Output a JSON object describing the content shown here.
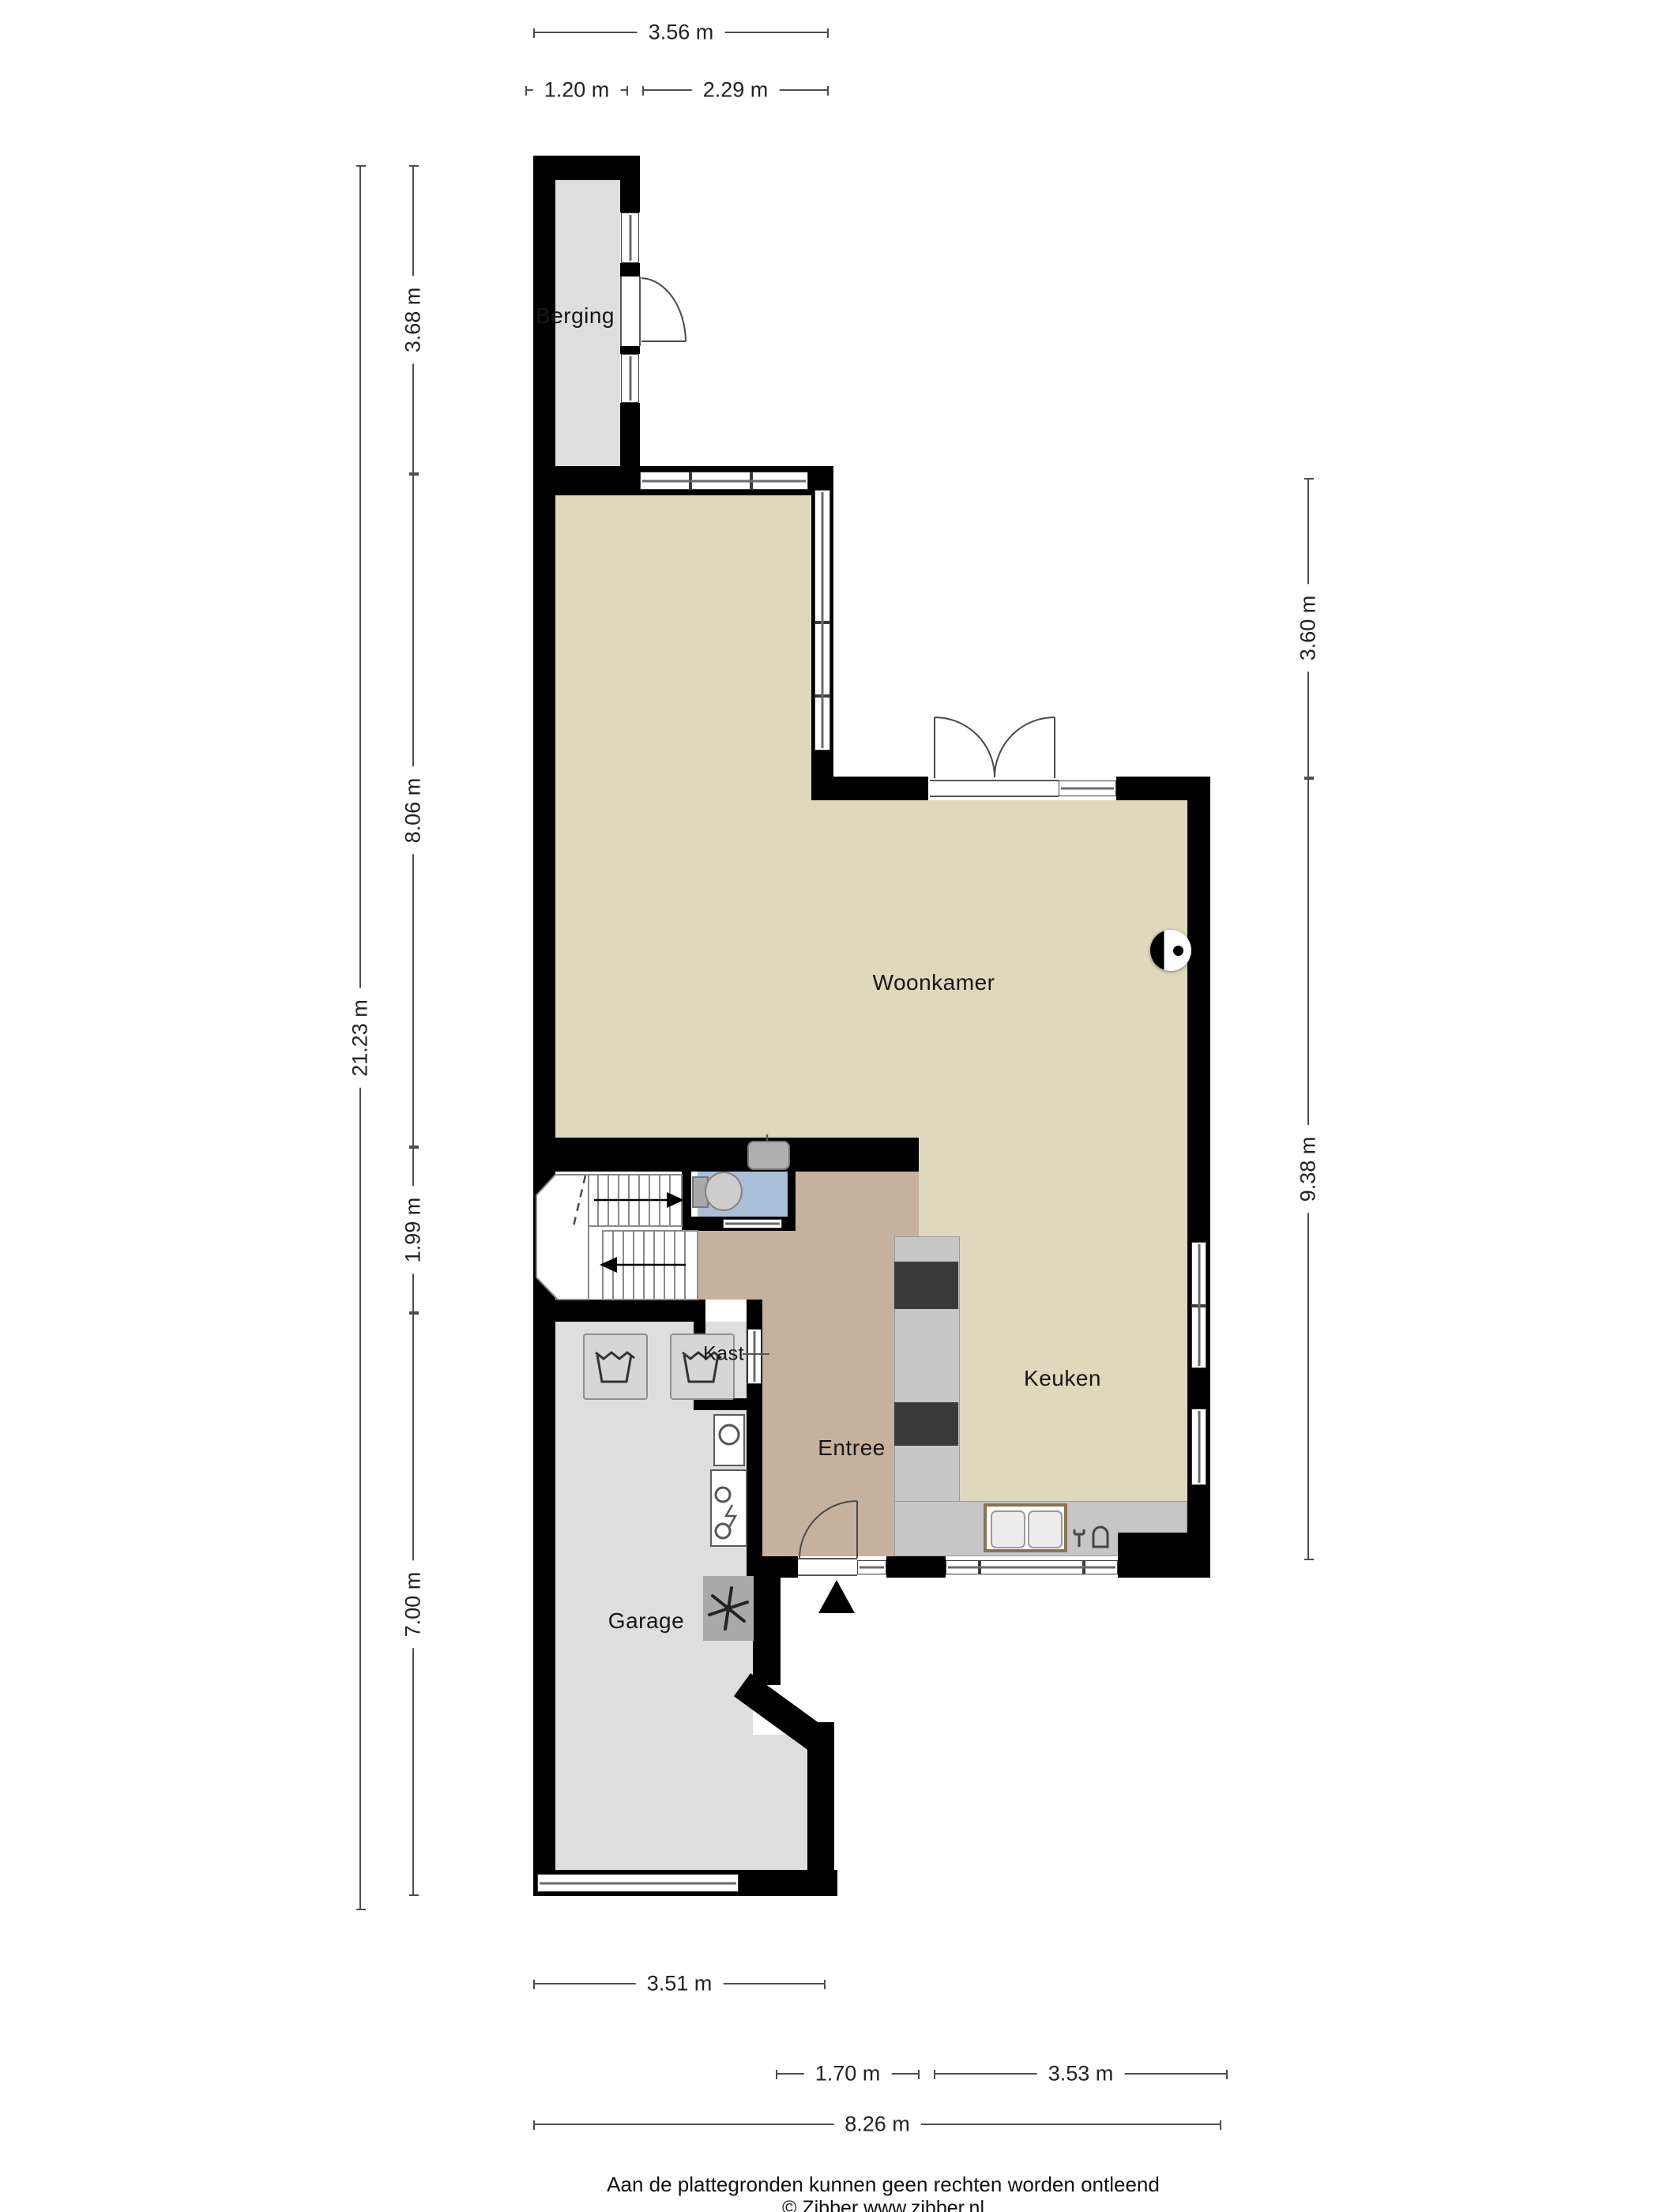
{
  "rooms": {
    "berging": "Berging",
    "woonkamer": "Woonkamer",
    "keuken": "Keuken",
    "entree": "Entree",
    "kast": "Kast",
    "garage": "Garage"
  },
  "dimensions": {
    "top_total": "3.56 m",
    "top_left": "1.20 m",
    "top_right": "2.29 m",
    "left_total": "21.23 m",
    "left_berging": "3.68 m",
    "left_woonkamer": "8.06 m",
    "left_hal": "1.99 m",
    "left_garage": "7.00 m",
    "right_upper": "3.60 m",
    "right_lower": "9.38 m",
    "bottom_garage": "3.51 m",
    "bottom_entree": "1.70 m",
    "bottom_keuken": "3.53 m",
    "bottom_total": "8.26 m"
  },
  "footer": {
    "line1": "Aan de plattegronden kunnen geen rechten worden ontleend",
    "line2": "© Zibber www.zibber.nl"
  },
  "colors": {
    "wall": "#000000",
    "floor-living": "#ded8bd",
    "floor-entree": "#c6b19e",
    "floor-toilet": "#a9bfd8",
    "floor-storage": "#dedede",
    "counter": "#c6c6c6",
    "cooktop": "#3a3a3a",
    "dim-line": "#4d4d4d"
  }
}
